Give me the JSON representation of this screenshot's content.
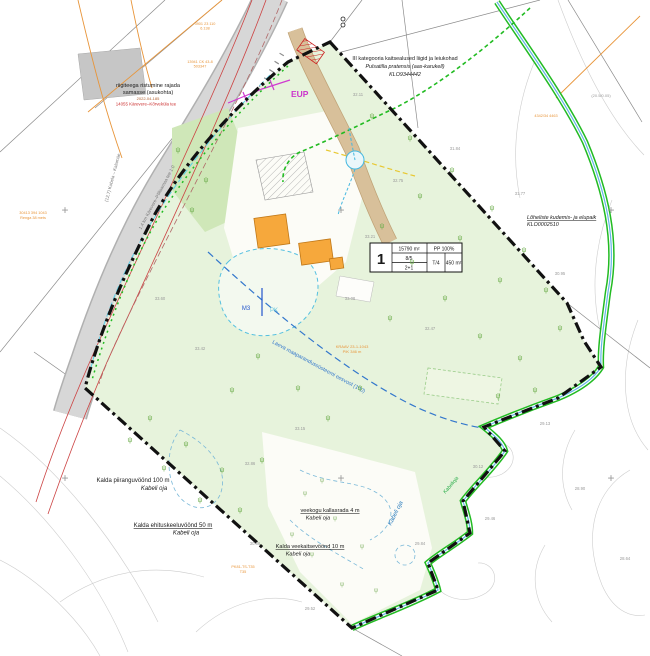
{
  "map": {
    "plot_box": {
      "number": "1",
      "area": "15790 m²",
      "coverage": "PP 100%",
      "storeys": "8/5",
      "units": "2+1",
      "type": "T/4",
      "building_area": "450 m²"
    },
    "labels": {
      "species_1": "III kategooria kaitsealused liigid ja leiukohad",
      "species_2": "Pulsatilla pratensis (aas-karukell)",
      "species_3": "KLO9344442",
      "salmonid_1": "Lõheliste kudemis- ja elupaik",
      "salmonid_2": "KLO0002510",
      "road_crossing_1": "riigiteega ristumine rajada",
      "road_crossing_2": "samasse (asukohta)",
      "road_permit": "2022-04-185",
      "road_name_red": "14055 Kärevere–Kõrveküla tee",
      "road_rot_1": "(12,7) Kobela – Kalamäe",
      "road_rot_2": "1,4 km Kärevere–Põltsamaa tee 1:0",
      "buffer_100_1": "Kalda piiranguvöönd 100 m",
      "buffer_100_2": "Kabeli oja",
      "build_ban_50_1": "Kalda ehituskeeluvöönd 50 m",
      "build_ban_50_2": "Kabeli oja",
      "kallasrada_1": "veekogu kallasrada 4 m",
      "kallasrada_2": "Kabeli oja",
      "water_prot_10_1": "Kalda veekaitsevöönd 10 m",
      "water_prot_10_2": "Kabeli oja",
      "stream_name": "Kabeli oja",
      "stream_name_2": "Kabelioja",
      "ditch_label": "Laeva maaparandussüsteemi eesvool (100)",
      "kraav_1": "KRAAV 23-1-1043",
      "kraav_2": "PIK 346 m",
      "eup": "EUP",
      "m3": "M3",
      "pk": "PK",
      "tiny_tl_1a": "3901 23 110",
      "tiny_tl_1b": "6.138",
      "tiny_tl_2a": "13941 CK 43-8",
      "tiny_tl_2b": "503347",
      "tiny_left_a": "30413 394 1043",
      "tiny_left_b": "Renga 38 mets",
      "tiny_bottom_a": "PK81-TS-T35",
      "tiny_bottom_b": "T35",
      "tiny_right_gray": "(20.5/0.05)",
      "tiny_right_orange": "4342/34 4463"
    },
    "colors": {
      "boundary": "#111111",
      "green_area": "#e7f3dc",
      "stream_green": "#22bb22",
      "building": "#f6a83c",
      "road_gray": "#d7d7d7",
      "magenta": "#cc33cc",
      "ditch_blue": "#3377cc",
      "red_line": "#cc4444",
      "orange_line": "#e8953a"
    },
    "elevations": [
      [
        358,
        96,
        "32.11"
      ],
      [
        455,
        150,
        "31.84"
      ],
      [
        520,
        195,
        "31.77"
      ],
      [
        560,
        275,
        "30.95"
      ],
      [
        350,
        300,
        "33.08"
      ],
      [
        430,
        330,
        "32.47"
      ],
      [
        300,
        430,
        "33.15"
      ],
      [
        250,
        465,
        "32.86"
      ],
      [
        478,
        468,
        "30.12"
      ],
      [
        420,
        545,
        "29.84"
      ],
      [
        200,
        350,
        "33.42"
      ],
      [
        545,
        425,
        "29.13"
      ],
      [
        370,
        238,
        "33.21"
      ],
      [
        160,
        300,
        "33.60"
      ],
      [
        490,
        520,
        "29.46"
      ],
      [
        255,
        545,
        "30.88"
      ],
      [
        310,
        610,
        "29.52"
      ],
      [
        580,
        490,
        "28.90"
      ],
      [
        625,
        560,
        "28.64"
      ],
      [
        398,
        182,
        "32.75"
      ]
    ],
    "trees": [
      [
        372,
        118
      ],
      [
        410,
        140
      ],
      [
        452,
        172
      ],
      [
        492,
        210
      ],
      [
        524,
        252
      ],
      [
        546,
        292
      ],
      [
        560,
        330
      ],
      [
        520,
        360
      ],
      [
        480,
        338
      ],
      [
        445,
        300
      ],
      [
        412,
        264
      ],
      [
        382,
        228
      ],
      [
        420,
        198
      ],
      [
        460,
        240
      ],
      [
        500,
        282
      ],
      [
        535,
        392
      ],
      [
        498,
        398
      ],
      [
        258,
        358
      ],
      [
        298,
        390
      ],
      [
        232,
        392
      ],
      [
        328,
        420
      ],
      [
        150,
        420
      ],
      [
        186,
        446
      ],
      [
        222,
        472
      ],
      [
        164,
        470
      ],
      [
        200,
        502
      ],
      [
        240,
        512
      ],
      [
        262,
        462
      ],
      [
        130,
        442
      ],
      [
        178,
        152
      ],
      [
        206,
        182
      ],
      [
        192,
        212
      ],
      [
        390,
        320
      ],
      [
        360,
        390
      ]
    ],
    "marsh": [
      [
        305,
        495
      ],
      [
        335,
        520
      ],
      [
        362,
        548
      ],
      [
        312,
        556
      ],
      [
        342,
        586
      ],
      [
        292,
        536
      ],
      [
        376,
        592
      ],
      [
        322,
        482
      ]
    ],
    "grid_crosses": [
      [
        65,
        210
      ],
      [
        341,
        210
      ],
      [
        611,
        210
      ],
      [
        65,
        478
      ],
      [
        341,
        478
      ],
      [
        611,
        478
      ]
    ]
  }
}
